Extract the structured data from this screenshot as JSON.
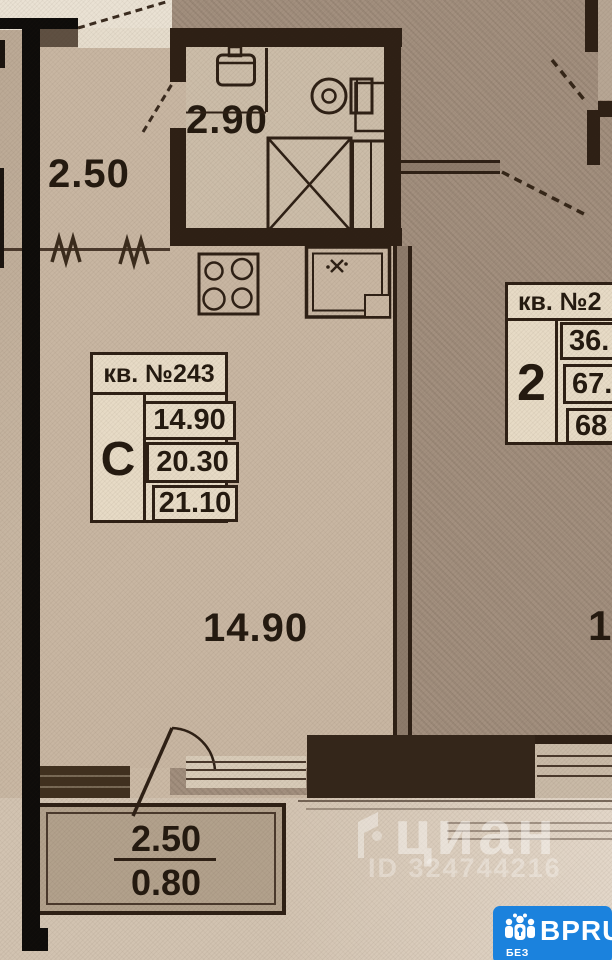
{
  "plan": {
    "unit_stamp": {
      "header": "кв. №243",
      "type_label": "С",
      "area_values": [
        "14.90",
        "20.30",
        "21.10"
      ]
    },
    "neighbor_stamp": {
      "header": "кв. №2",
      "rooms_label": "2",
      "area_values": [
        "36.",
        "67.",
        "68"
      ]
    },
    "dimension_labels": {
      "bathroom_width": "2.90",
      "hallway_width": "2.50",
      "room_area": "14.90",
      "balcony_width": "2.50",
      "balcony_area": "0.80",
      "neighbor_room_partial": "1"
    }
  },
  "watermarks": {
    "cian_logo_text": "циан",
    "listing_id": "ID 324744216",
    "badge": {
      "brand": "BPRU",
      "tagline": "БЕЗ ПОСРЕДНИКОВ",
      "background_color": "#1b82dd"
    }
  },
  "colors": {
    "wall": "#2e2015",
    "paper": "#c8b6a2",
    "neighbor_floor": "#a3907f"
  }
}
